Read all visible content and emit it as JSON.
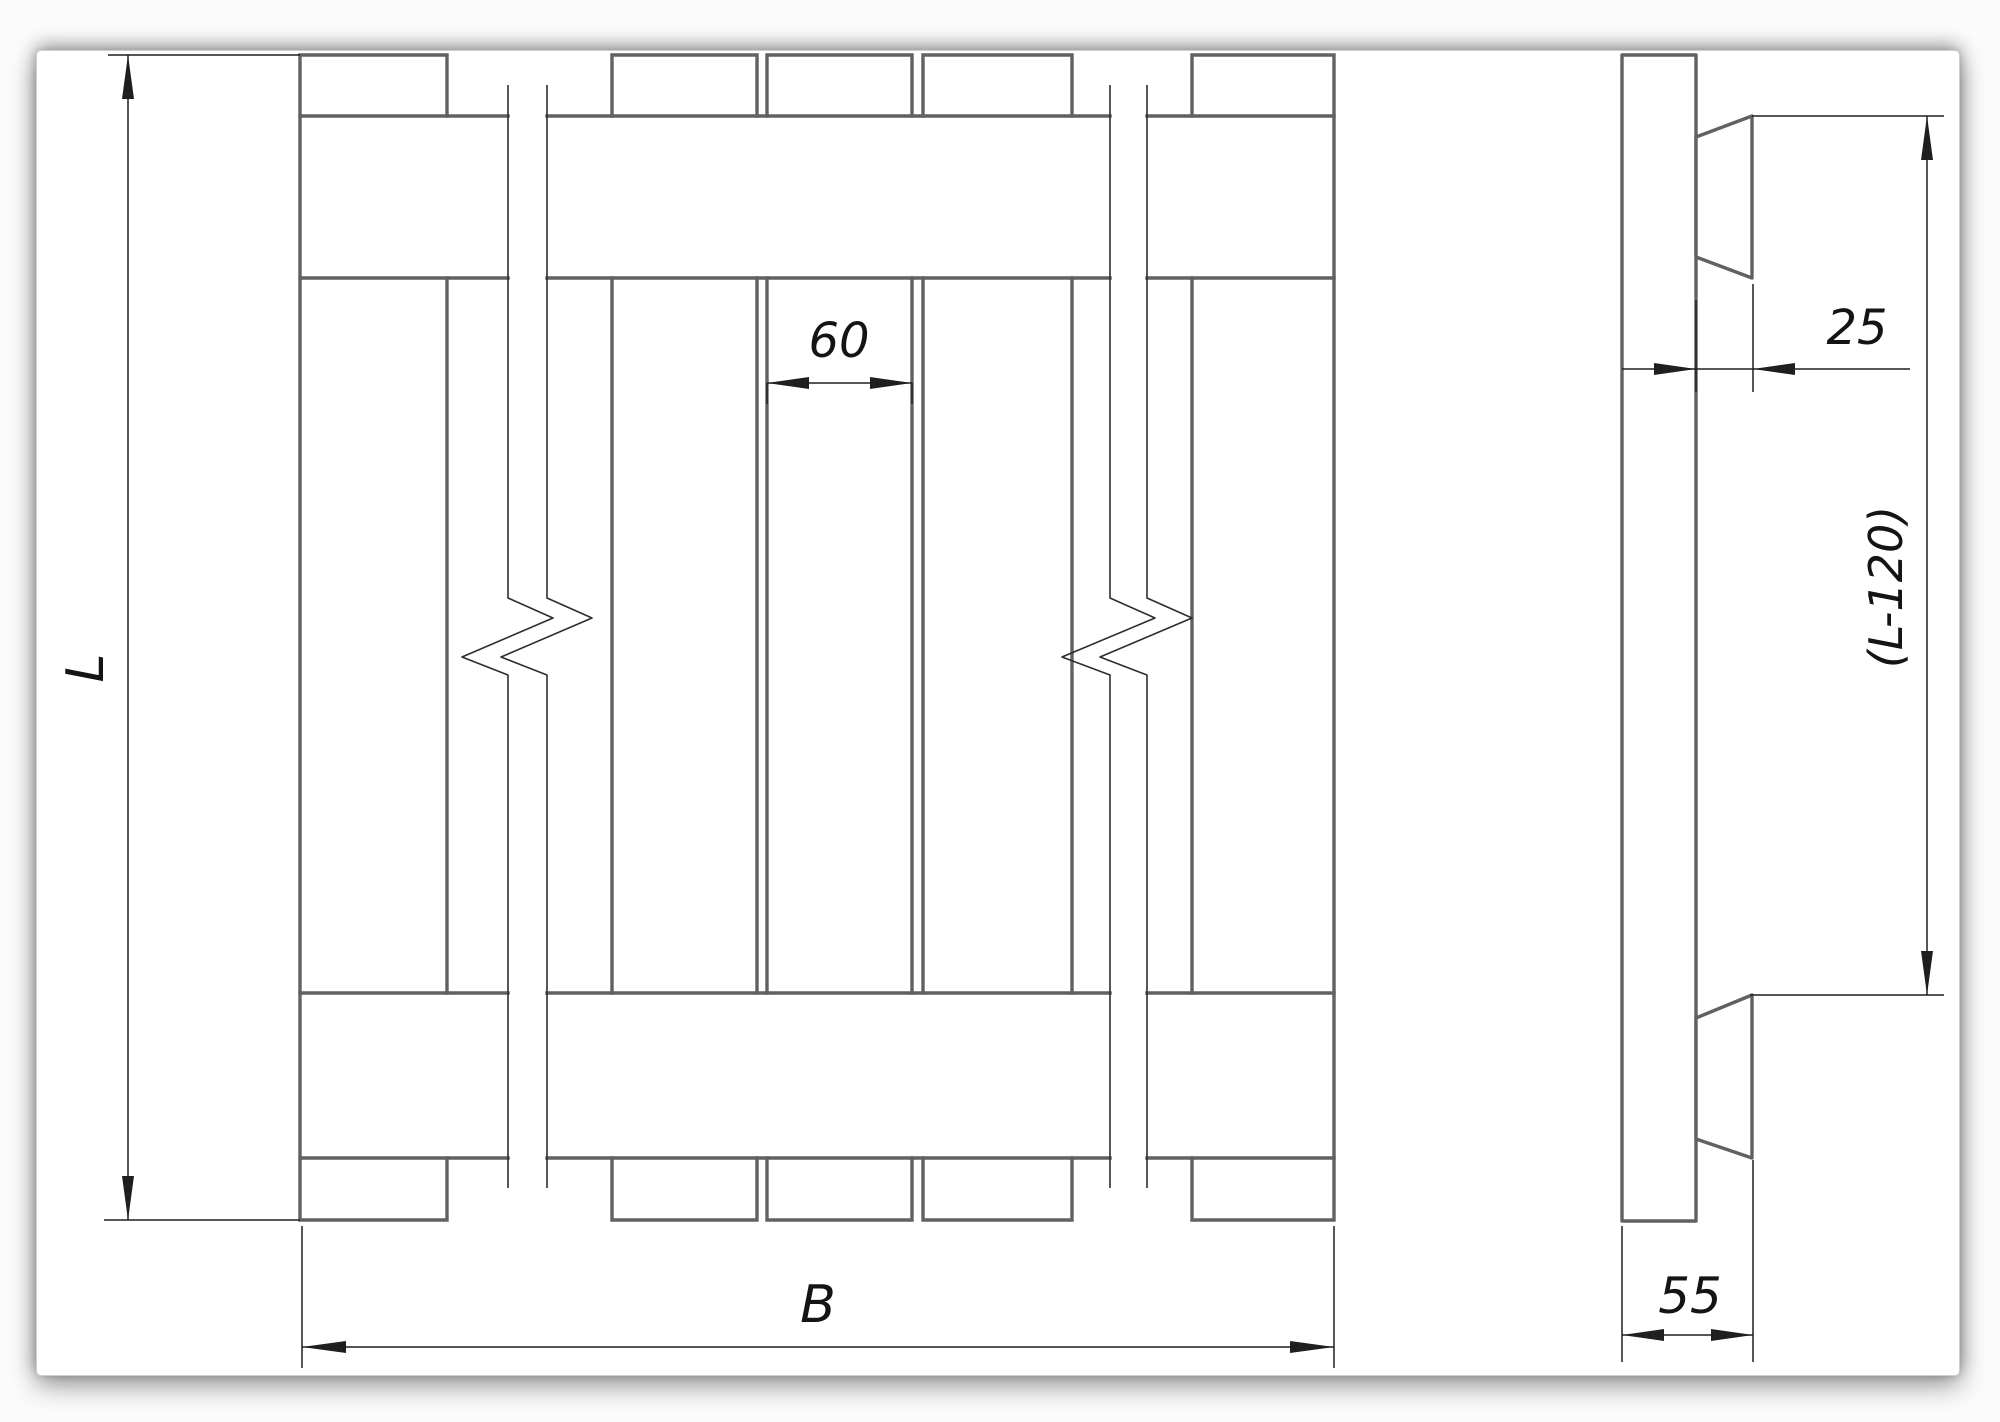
{
  "drawing": {
    "views": {
      "front_view": "shield front view with vertical boards, two horizontal cleat bands and break lines",
      "side_view": "shield side view: board edge with two bevelled cleats"
    },
    "labels": {
      "overall_length": "L",
      "overall_width": "B",
      "board_width": "60",
      "cleat_thickness": "25",
      "cleat_spacing": "(L-120)",
      "panel_thickness": "55"
    },
    "dimensions": [
      {
        "name": "overall-length",
        "text": "L",
        "orientation": "vertical",
        "location": "left of front view"
      },
      {
        "name": "overall-width",
        "text": "B",
        "orientation": "horizontal",
        "location": "below front view"
      },
      {
        "name": "board-width",
        "text": "60",
        "orientation": "horizontal",
        "location": "between boards, upper middle of front view"
      },
      {
        "name": "cleat-thickness",
        "text": "25",
        "orientation": "horizontal",
        "location": "right of side view, top"
      },
      {
        "name": "cleat-spacing",
        "text": "(L-120)",
        "orientation": "vertical",
        "location": "right of side view"
      },
      {
        "name": "panel-thickness",
        "text": "55",
        "orientation": "horizontal",
        "location": "below side view"
      }
    ],
    "colors": {
      "paper": "#ffffff",
      "contour_line": "#616161",
      "dimension_line": "#1f1f1f",
      "text": "#141414"
    }
  }
}
